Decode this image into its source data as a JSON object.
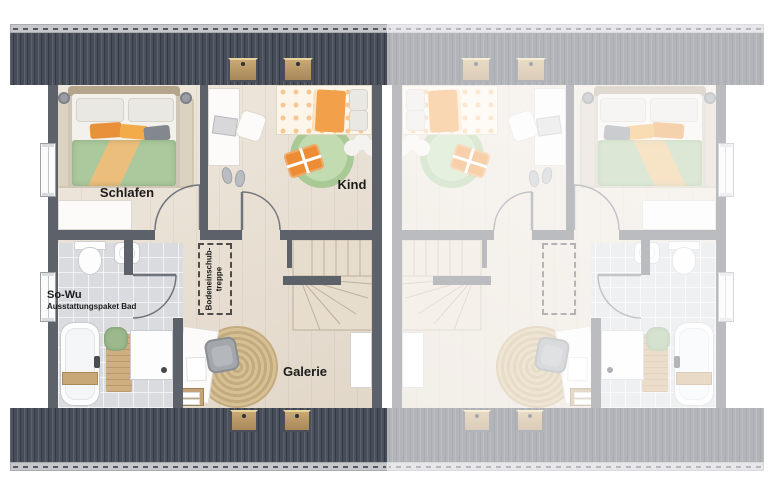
{
  "plan": {
    "rooms": {
      "bedroom_label": "Schlafen",
      "child_label": "Kind",
      "gallery_label": "Galerie",
      "bath_label": "So-Wu",
      "bath_sublabel": "Ausstattungspaket Bad",
      "attic_stair_label_line1": "Bodeneinschub-",
      "attic_stair_label_line2": "treppe"
    },
    "colors": {
      "roof_dark": "#474c59",
      "ridge_cap": "#c5c7cb",
      "wall": "#5d6169",
      "wood_floor": "#e9dfd1",
      "bath_tile": "#d9dbde",
      "duvet_green": "#abc99c",
      "accent_orange": "#ec8c34",
      "rug_jute": "#c3ab7e",
      "rug_green": "#a9c996",
      "label_text": "#1b1b1b",
      "fade_overlay": "rgba(255,255,255,0.58)"
    }
  }
}
